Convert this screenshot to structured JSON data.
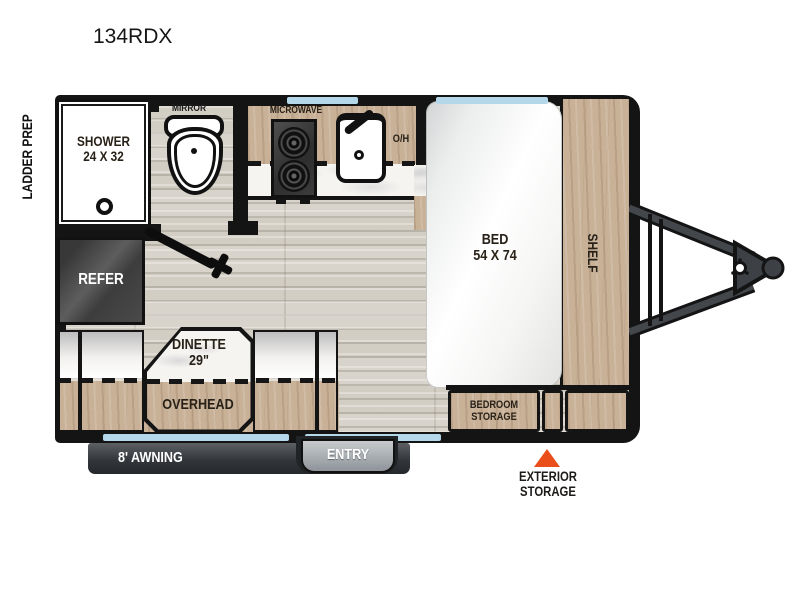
{
  "title": "134RDX",
  "exterior": {
    "ladder_prep": "LADDER PREP",
    "awning": "8' AWNING",
    "entry": "ENTRY",
    "exterior_storage": "EXTERIOR\nSTORAGE"
  },
  "rooms": {
    "shower": "SHOWER\n24 X 32",
    "mirror": "MIRROR",
    "microwave": "MICROWAVE",
    "overhead_cabinet": "O/H",
    "refer": "REFER",
    "dinette": "DINETTE\n29\"",
    "overhead": "OVERHEAD",
    "bed": "BED\n54 X 74",
    "shelf": "SHELF",
    "bedroom_storage": "BEDROOM\nSTORAGE"
  },
  "colors": {
    "wall": "#141414",
    "wood": "#c8b197",
    "floor": "#d8d4cb",
    "window": "#b5d7ea",
    "marble": "#f5f4f1",
    "accent_triangle": "#e94e1b",
    "refer_dark": "#3f3f3f",
    "awning_dark": "#33363a",
    "entry_gray": "#9aa0a5"
  }
}
